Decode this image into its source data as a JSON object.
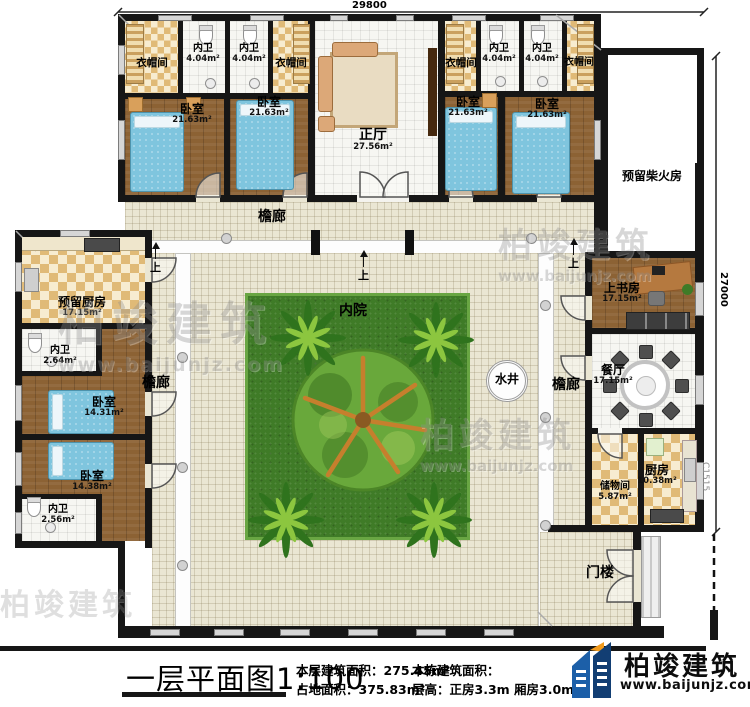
{
  "dimensions": {
    "top_width": "29800",
    "right_height": "27000",
    "window_code": "C1515"
  },
  "rooms": {
    "cloakroom": {
      "label": "衣帽间"
    },
    "bath_top": {
      "label": "内卫",
      "area": "4.04m²"
    },
    "bedroom_top": {
      "label": "卧室",
      "area": "21.63m²"
    },
    "hall": {
      "label": "正厅",
      "area": "27.56m²"
    },
    "reserved_kitchen": {
      "label": "预留厨房",
      "area": "17.15m²"
    },
    "bath_left_upper": {
      "label": "内卫",
      "area": "2.64m²"
    },
    "bedroom_left_upper": {
      "label": "卧室",
      "area": "14.31m²"
    },
    "bedroom_left_lower": {
      "label": "卧室",
      "area": "14.38m²"
    },
    "bath_left_lower": {
      "label": "内卫",
      "area": "2.56m²"
    },
    "study": {
      "label": "上书房",
      "area": "17.15m²"
    },
    "dining": {
      "label": "餐厅",
      "area": "17.15m²"
    },
    "storage": {
      "label": "储物间",
      "area": "5.87m²"
    },
    "kitchen": {
      "label": "厨房",
      "area": "10.38m²"
    },
    "firewood": {
      "label": "预留柴火房"
    },
    "gatehouse": {
      "label": "门楼"
    }
  },
  "labels": {
    "veranda": "檐廊",
    "courtyard": "内院",
    "well": "水井",
    "up": "上"
  },
  "footer": {
    "title": "一层平面图1:100",
    "stats": [
      {
        "label": "本层建筑面积：",
        "value": "275.45m²"
      },
      {
        "label": "占地面积：",
        "value": "375.83m²"
      },
      {
        "label": "本栋建筑面积：",
        "value": ""
      },
      {
        "label": "层高：",
        "value": "正房3.3m 厢房3.0m"
      }
    ],
    "brand": {
      "name": "柏竣建筑",
      "site": "www.baijunjz.com"
    }
  },
  "watermark": {
    "name": "柏竣建筑",
    "site": "www.baijunjz.com"
  }
}
